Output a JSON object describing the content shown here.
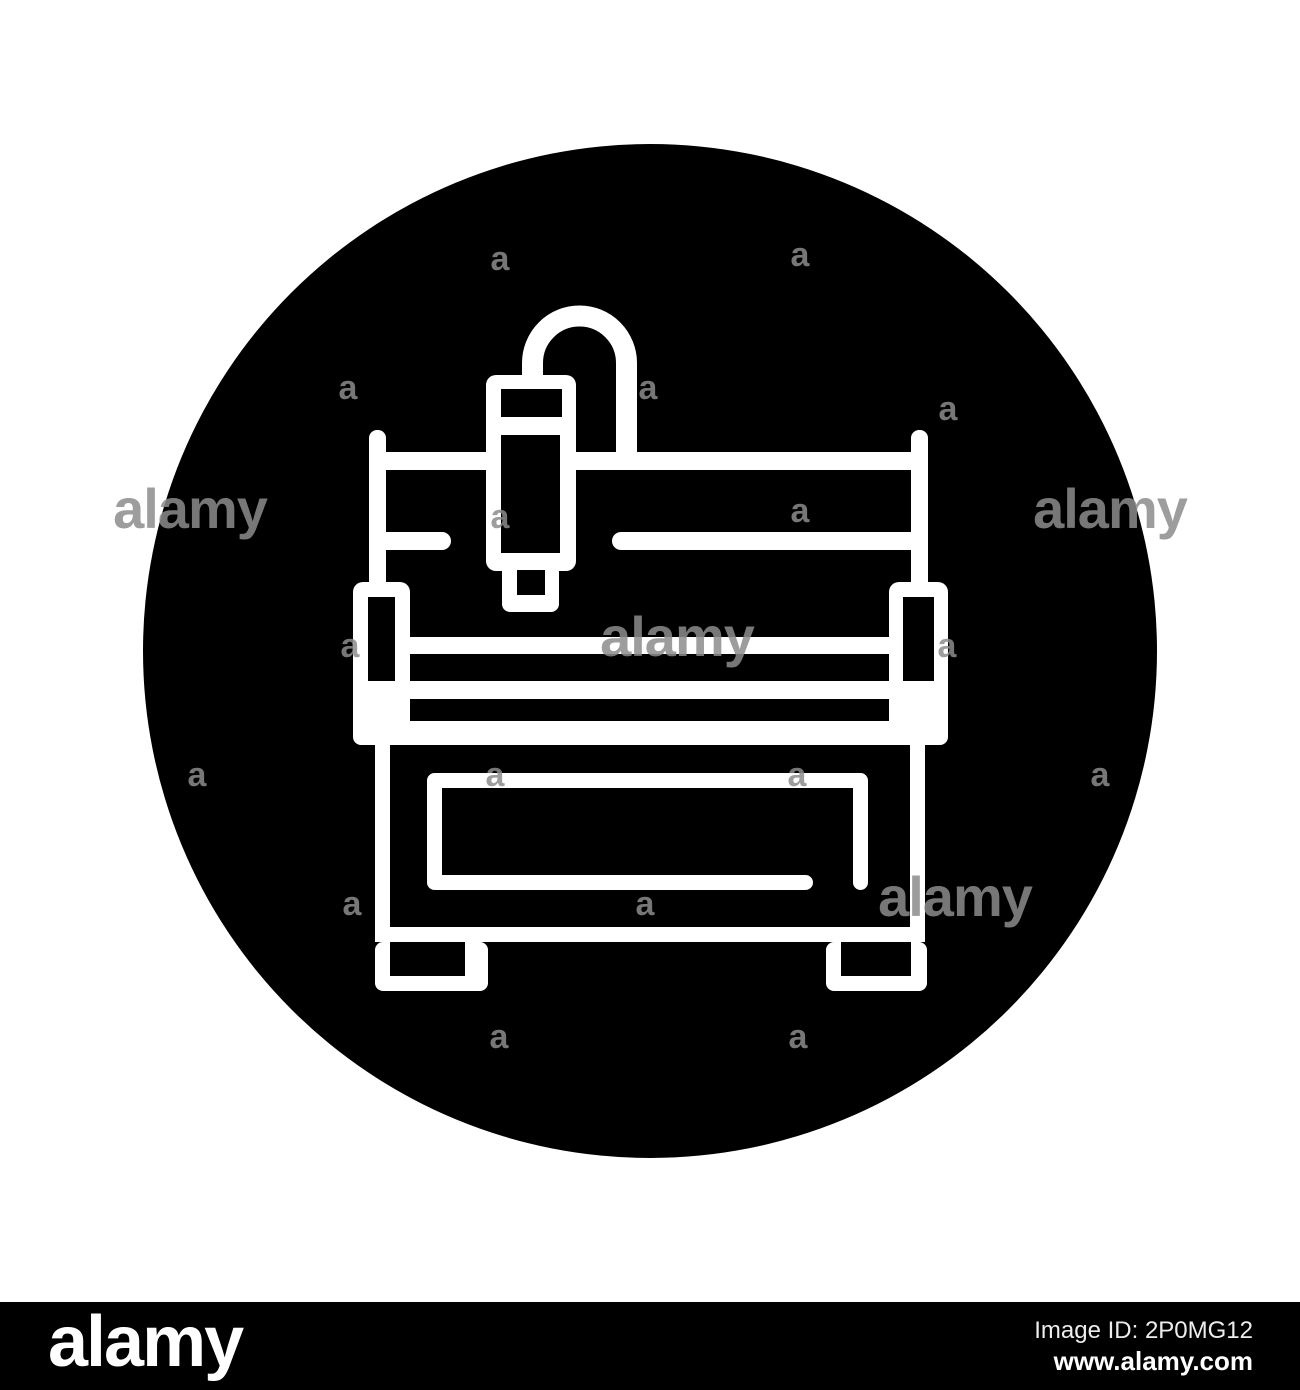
{
  "image": {
    "subject_label": "CNC milling machine line icon in black circle",
    "colors": {
      "background": "#ffffff",
      "circle_fill": "#000000",
      "line_color": "#ffffff",
      "watermark_gray": "#8c8c8c",
      "credit_bar_bg": "#000000",
      "credit_text": "#ededed"
    }
  },
  "credit_bar": {
    "brand_logo_text": "alamy",
    "image_id_text": "Image ID: 2P0MG12",
    "url_text": "www.alamy.com"
  },
  "watermarks": {
    "letter_text": "a",
    "word_text": "alamy",
    "items": [
      {
        "text": "a",
        "x": 500,
        "y": 270
      },
      {
        "text": "a",
        "x": 800,
        "y": 266
      },
      {
        "text": "a",
        "x": 348,
        "y": 399
      },
      {
        "text": "a",
        "x": 648,
        "y": 399
      },
      {
        "text": "a",
        "x": 948,
        "y": 420
      },
      {
        "text": "alamy",
        "x": 190,
        "y": 528
      },
      {
        "text": "a",
        "x": 500,
        "y": 528
      },
      {
        "text": "a",
        "x": 800,
        "y": 522
      },
      {
        "text": "alamy",
        "x": 1110,
        "y": 528
      },
      {
        "text": "a",
        "x": 350,
        "y": 657
      },
      {
        "text": "alamy",
        "x": 677,
        "y": 656
      },
      {
        "text": "a",
        "x": 947,
        "y": 657
      },
      {
        "text": "a",
        "x": 197,
        "y": 786
      },
      {
        "text": "a",
        "x": 495,
        "y": 786
      },
      {
        "text": "a",
        "x": 797,
        "y": 786
      },
      {
        "text": "a",
        "x": 1100,
        "y": 786
      },
      {
        "text": "a",
        "x": 352,
        "y": 915
      },
      {
        "text": "a",
        "x": 645,
        "y": 915
      },
      {
        "text": "alamy",
        "x": 955,
        "y": 916
      },
      {
        "text": "a",
        "x": 499,
        "y": 1048
      },
      {
        "text": "a",
        "x": 798,
        "y": 1048
      }
    ]
  }
}
